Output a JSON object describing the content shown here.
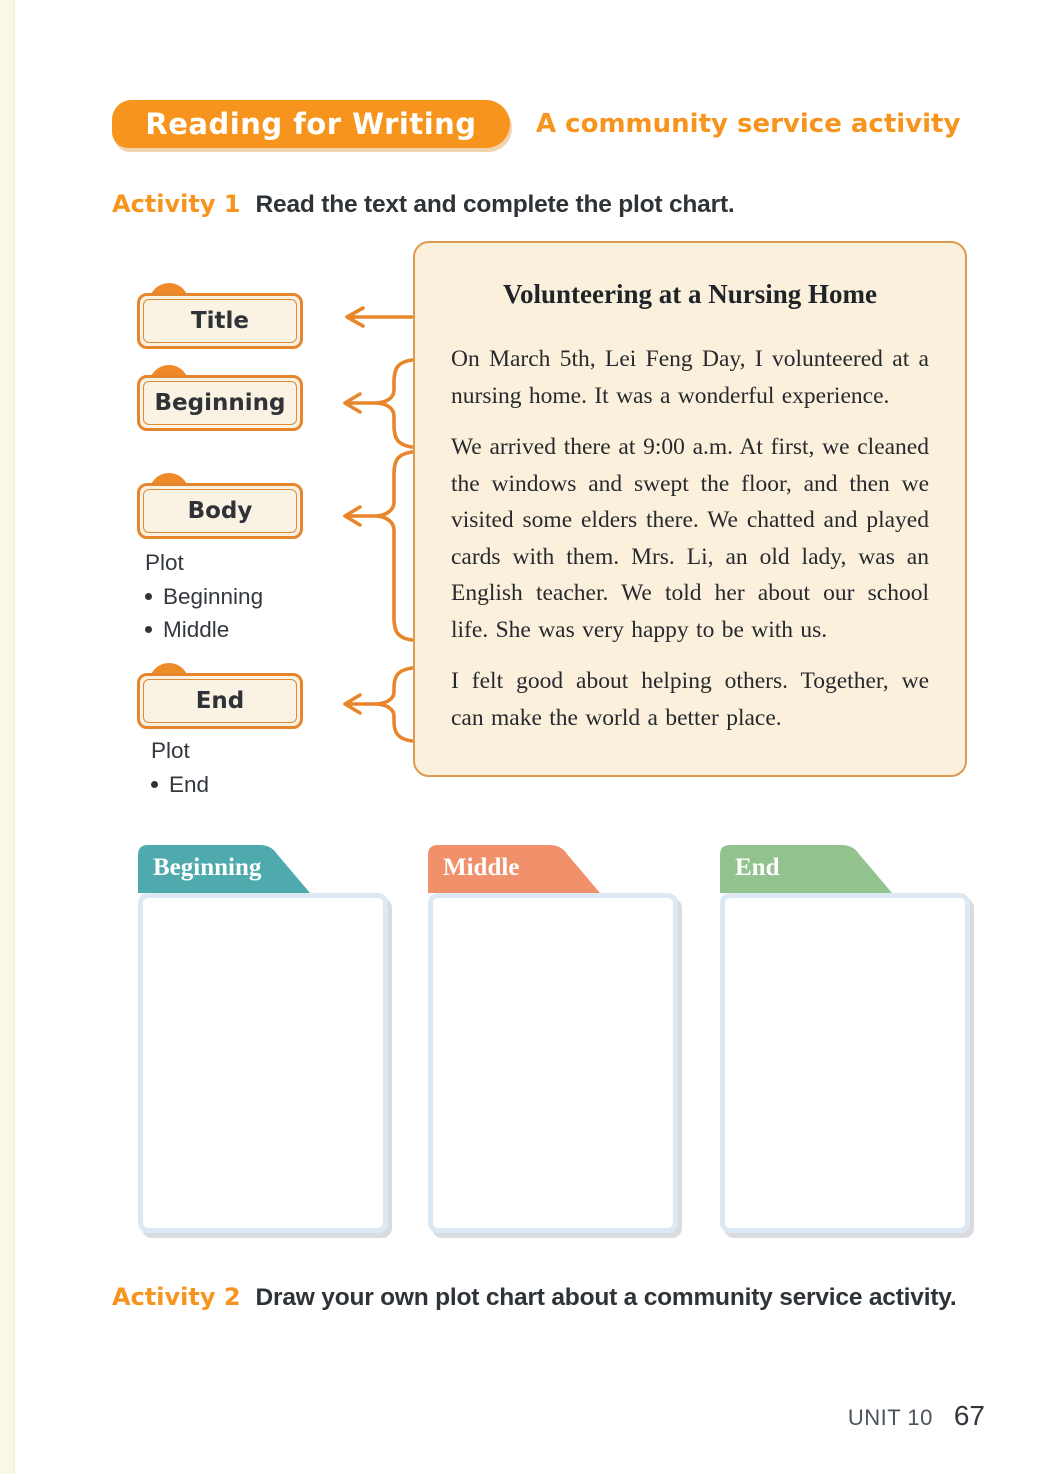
{
  "header": {
    "badge": "Reading for Writing",
    "subtitle": "A community service activity"
  },
  "activity1": {
    "label": "Activity 1",
    "instruction": "Read the text and complete the plot chart."
  },
  "plot_chart": {
    "nodes": [
      {
        "label": "Title"
      },
      {
        "label": "Beginning"
      },
      {
        "label": "Body",
        "sub_label": "Plot",
        "bullets": [
          "Beginning",
          "Middle"
        ]
      },
      {
        "label": "End",
        "sub_label": "Plot",
        "bullets": [
          "End"
        ]
      }
    ]
  },
  "passage": {
    "title": "Volunteering at a Nursing Home",
    "paragraphs": [
      "On March 5th, Lei Feng Day, I volunteered at a nursing home. It was a wonderful experience.",
      "We arrived there at 9:00 a.m. At first, we cleaned the windows and swept the floor, and then we visited some elders there. We chatted and played cards with them. Mrs. Li, an old lady, was an English teacher. We told her about our school life. She was very happy to be with us.",
      "I felt good about helping others. Together, we can make the world a better place."
    ]
  },
  "answer_boxes": [
    {
      "label": "Beginning",
      "color": "#4FAAAD"
    },
    {
      "label": "Middle",
      "color": "#F0916B"
    },
    {
      "label": "End",
      "color": "#92C38E"
    }
  ],
  "activity2": {
    "label": "Activity 2",
    "instruction": "Draw your own plot chart about a community service activity."
  },
  "footer": {
    "unit": "UNIT 10",
    "page_number": "67"
  },
  "colors": {
    "accent_orange": "#F7941E",
    "diagram_orange": "#E8862C",
    "plaque_border": "#E5862E",
    "plaque_bg": "#FAF3E3",
    "passage_bg": "#FBF0DC",
    "passage_border": "#DE9A50",
    "answer_box_border": "#DCE9F4"
  }
}
